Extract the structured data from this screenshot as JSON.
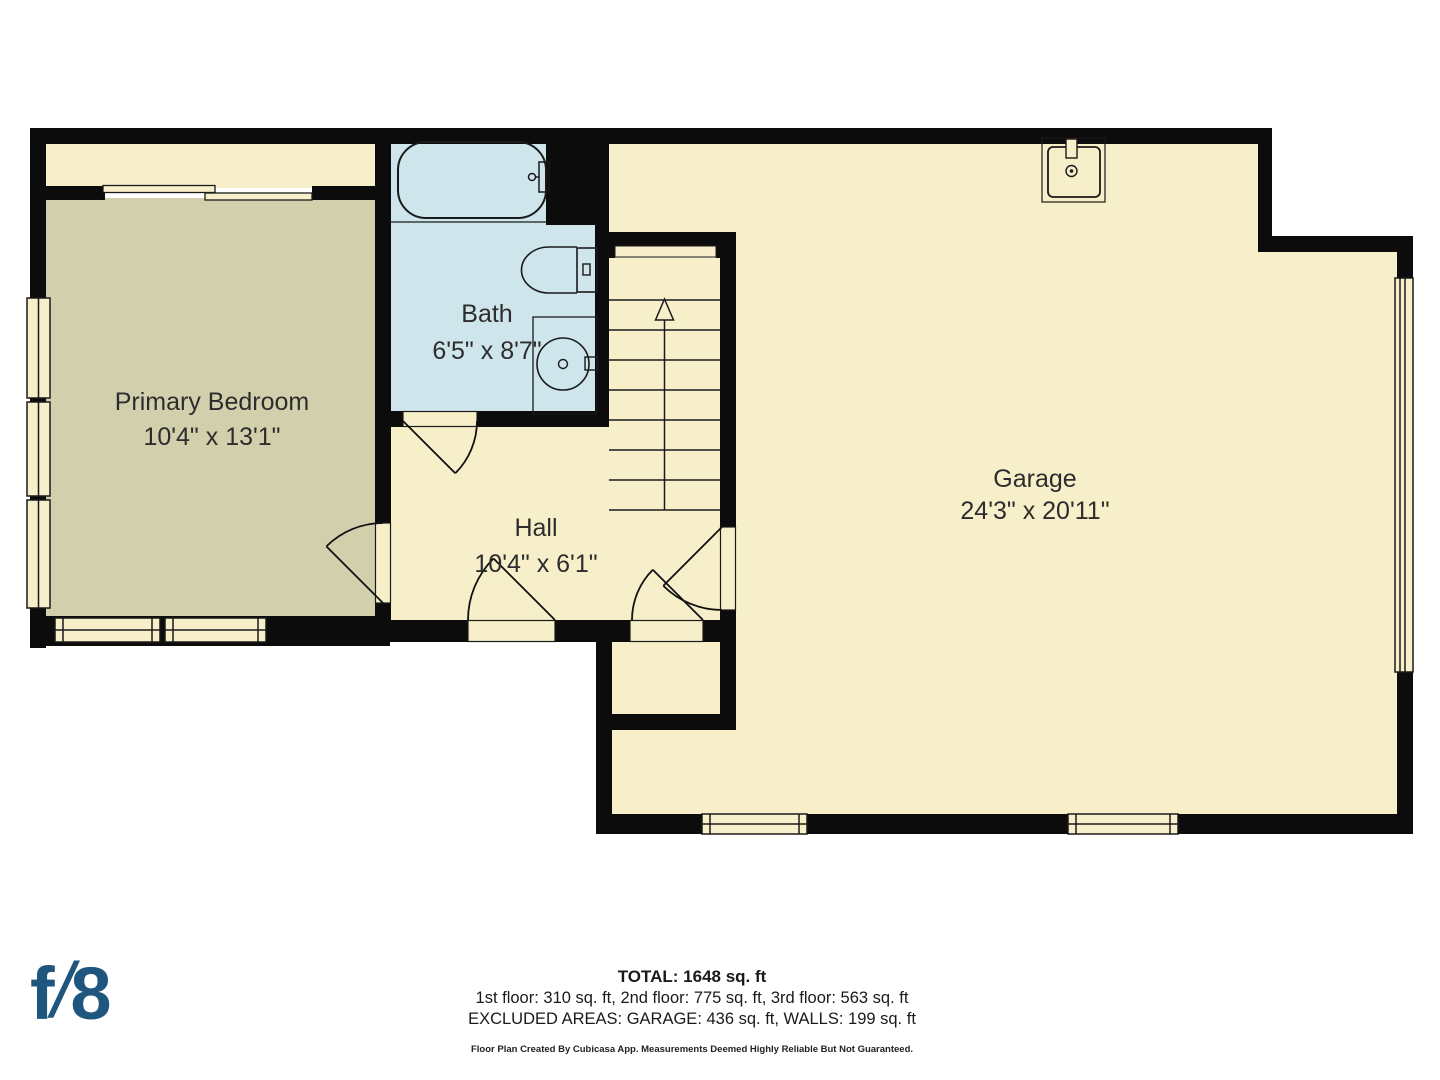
{
  "plan": {
    "rooms": [
      {
        "name": "Primary Bedroom",
        "dims": "10'4\" x 13'1\""
      },
      {
        "name": "Bath",
        "dims": "6'5\" x 8'7\""
      },
      {
        "name": "Hall",
        "dims": "10'4\" x 6'1\""
      },
      {
        "name": "Garage",
        "dims": "24'3\" x 20'11\""
      }
    ],
    "fixtures": [
      "bathtub",
      "toilet",
      "sink",
      "garage-sink",
      "staircase-up"
    ],
    "colors": {
      "wall": "#0c0c0c",
      "floor_cream": "#f7efca",
      "floor_bedroom": "#d2cfad",
      "floor_bath": "#cfe5ec",
      "line": "#1a1a1a"
    }
  },
  "footer": {
    "total": "TOTAL: 1648 sq. ft",
    "floors": "1st floor: 310 sq. ft, 2nd floor: 775 sq. ft, 3rd floor: 563 sq. ft",
    "excluded": "EXCLUDED AREAS: GARAGE: 436 sq. ft, WALLS: 199 sq. ft",
    "disclaimer": "Floor Plan Created By Cubicasa App. Measurements Deemed Highly Reliable But Not Guaranteed."
  },
  "logo": {
    "f": "f",
    "slash": "/",
    "eight": "8",
    "color": "#1f567d"
  }
}
